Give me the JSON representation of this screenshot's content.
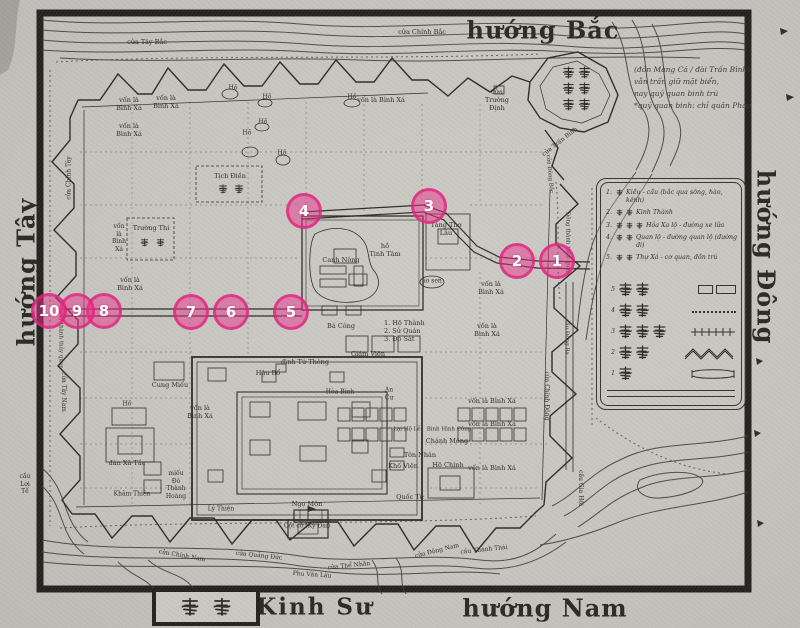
{
  "colors": {
    "paper": "#c6c4bf",
    "ink": "#2e2c26",
    "frame": "#24221e",
    "marker_pink": "#e83490",
    "marker_fill": "rgba(232,52,140,0.5)"
  },
  "compass": {
    "north": "hướng Bắc",
    "south": "hướng Nam",
    "east": "hướng Đông",
    "west": "hướng Tây",
    "capital": "Kinh Sư",
    "capital_seal": "京師"
  },
  "note": {
    "lines": [
      "(đồn Mang Cá / đài Trấn Bình)",
      "vẫn trấn giữ mặt biển,",
      "nay quý quan binh trú",
      "*quý quan binh: chỉ quân Pháp"
    ]
  },
  "legend": {
    "items": [
      {
        "num": "1.",
        "cjk": "橋",
        "text": "Kiều - cầu (bắc qua sông, hào, kênh)"
      },
      {
        "num": "2.",
        "cjk": "京城",
        "text": "Kinh Thành"
      },
      {
        "num": "3.",
        "cjk": "火車路",
        "text": "Hỏa Xa lộ - đường xe lửa"
      },
      {
        "num": "4.",
        "cjk": "官路",
        "text": "Quan lộ - đường quan lộ (đường đi)"
      },
      {
        "num": "5.",
        "cjk": "署舍",
        "text": "Thự Xá - cơ quan, đồn trú"
      }
    ],
    "glyph_rows": [
      {
        "num": "5",
        "cjk": "署舍",
        "sym": "rects"
      },
      {
        "num": "4",
        "cjk": "官路",
        "sym": "dots"
      },
      {
        "num": "3",
        "cjk": "火車路",
        "sym": "rail"
      },
      {
        "num": "2",
        "cjk": "京城",
        "sym": "zigzag"
      },
      {
        "num": "1",
        "cjk": "橋",
        "sym": "bridge"
      }
    ]
  },
  "markers": [
    {
      "n": "1",
      "x": 557,
      "y": 261
    },
    {
      "n": "2",
      "x": 517,
      "y": 261
    },
    {
      "n": "3",
      "x": 429,
      "y": 206
    },
    {
      "n": "4",
      "x": 304,
      "y": 211
    },
    {
      "n": "5",
      "x": 291,
      "y": 312
    },
    {
      "n": "6",
      "x": 231,
      "y": 312
    },
    {
      "n": "7",
      "x": 191,
      "y": 312
    },
    {
      "n": "8",
      "x": 104,
      "y": 311
    },
    {
      "n": "9",
      "x": 77,
      "y": 311
    },
    {
      "n": "10",
      "x": 49,
      "y": 311
    }
  ],
  "map_labels": [
    {
      "t": "cửa Tây Bắc",
      "x": 147,
      "y": 42
    },
    {
      "t": "cửa Chính Bắc",
      "x": 422,
      "y": 32
    },
    {
      "t": "cửa\nTrường\nĐịnh",
      "x": 497,
      "y": 100
    },
    {
      "t": "cửa Trấn Bình",
      "x": 560,
      "y": 142,
      "rot": -38,
      "s": 6
    },
    {
      "t": "cửa Đông Bắc",
      "x": 549,
      "y": 174,
      "rot": 85,
      "s": 5.5
    },
    {
      "t": "vốn là\nBình Xá",
      "x": 129,
      "y": 104
    },
    {
      "t": "vốn là\nBình Xá",
      "x": 166,
      "y": 102
    },
    {
      "t": "vốn là\nBình Xá",
      "x": 129,
      "y": 130
    },
    {
      "t": "vốn là Bình Xá",
      "x": 381,
      "y": 100
    },
    {
      "t": "Hồ",
      "x": 233,
      "y": 88,
      "s": 6
    },
    {
      "t": "Hồ",
      "x": 267,
      "y": 97,
      "s": 6
    },
    {
      "t": "Hồ",
      "x": 263,
      "y": 122,
      "s": 6
    },
    {
      "t": "Hồ",
      "x": 247,
      "y": 133,
      "s": 6
    },
    {
      "t": "Hồ",
      "x": 352,
      "y": 97,
      "s": 6
    },
    {
      "t": "Hồ",
      "x": 282,
      "y": 153,
      "s": 6
    },
    {
      "t": "Tịch Điền",
      "x": 230,
      "y": 176
    },
    {
      "t": "Trường Thi",
      "x": 151,
      "y": 228
    },
    {
      "t": "vốn\nlà\nBình\nXá",
      "x": 119,
      "y": 238,
      "s": 6
    },
    {
      "t": "vốn là\nBình Xá",
      "x": 130,
      "y": 284
    },
    {
      "t": "hồ\nTịnh Tâm",
      "x": 385,
      "y": 250
    },
    {
      "t": "Canh Nông",
      "x": 341,
      "y": 260
    },
    {
      "t": "Tàng Thơ\nLâu",
      "x": 446,
      "y": 229
    },
    {
      "t": "ao sen",
      "x": 432,
      "y": 281,
      "s": 6
    },
    {
      "t": "vốn là\nBình Xá",
      "x": 491,
      "y": 288
    },
    {
      "t": "vốn là\nBình Xá",
      "x": 487,
      "y": 330
    },
    {
      "t": "Bá Công",
      "x": 341,
      "y": 326
    },
    {
      "t": "1. Hộ Thành\n2. Sử Quán\n3. Đô Sát",
      "x": 409,
      "y": 331,
      "align": "left",
      "w": 50
    },
    {
      "t": "Giám Viện",
      "x": 368,
      "y": 354
    },
    {
      "t": "đình Tứ Thông",
      "x": 305,
      "y": 362
    },
    {
      "t": "Hậu Bổ",
      "x": 268,
      "y": 373
    },
    {
      "t": "Hòa Bình",
      "x": 340,
      "y": 392,
      "s": 6
    },
    {
      "t": "An\nCư",
      "x": 389,
      "y": 394,
      "s": 6
    },
    {
      "t": "Cung Miếu",
      "x": 170,
      "y": 385
    },
    {
      "t": "Hồ",
      "x": 127,
      "y": 404,
      "s": 6
    },
    {
      "t": "vốn là\nBình Xá",
      "x": 200,
      "y": 412
    },
    {
      "t": "vốn là Bình Xá",
      "x": 492,
      "y": 401
    },
    {
      "t": "vốn là Bình Xá",
      "x": 492,
      "y": 424
    },
    {
      "t": "vốn là Bình Xá",
      "x": 492,
      "y": 468
    },
    {
      "t": "Lại  Hộ  Lễ",
      "x": 407,
      "y": 430,
      "s": 5.5
    },
    {
      "t": "Binh Hình Công",
      "x": 449,
      "y": 430,
      "s": 5.5
    },
    {
      "t": "Chánh Mông",
      "x": 447,
      "y": 441
    },
    {
      "t": "Tôn Nhân",
      "x": 420,
      "y": 455
    },
    {
      "t": "Khố Viện",
      "x": 403,
      "y": 466
    },
    {
      "t": "Hộ Chính",
      "x": 448,
      "y": 465
    },
    {
      "t": "Quốc Tử",
      "x": 410,
      "y": 497
    },
    {
      "t": "đàn Xã Tắc",
      "x": 127,
      "y": 463
    },
    {
      "t": "Khâm Thiên",
      "x": 132,
      "y": 494,
      "s": 6
    },
    {
      "t": "miếu\nĐô\nThành\nHoàng",
      "x": 176,
      "y": 485,
      "s": 6
    },
    {
      "t": "Lý Thiện",
      "x": 221,
      "y": 509,
      "s": 6
    },
    {
      "t": "Ngọ Môn",
      "x": 307,
      "y": 504
    },
    {
      "t": "Cột cờ (Kỳ Đài)",
      "x": 307,
      "y": 526,
      "s": 6
    },
    {
      "t": "cửa Chính Nam",
      "x": 182,
      "y": 556,
      "rot": 10,
      "s": 6
    },
    {
      "t": "cửa Quảng Đức",
      "x": 259,
      "y": 556,
      "rot": 6,
      "s": 6
    },
    {
      "t": "Phu Văn Lâu",
      "x": 312,
      "y": 575,
      "rot": 4,
      "s": 6
    },
    {
      "t": "cửa Thể Nhân",
      "x": 349,
      "y": 566,
      "rot": -6,
      "s": 6
    },
    {
      "t": "cửa Đông Nam",
      "x": 437,
      "y": 551,
      "rot": -14,
      "s": 6
    },
    {
      "t": "cầu Thành Thái",
      "x": 484,
      "y": 550,
      "rot": -6,
      "s": 6
    },
    {
      "t": "cầu Gia Hội",
      "x": 580,
      "y": 488,
      "rot": 90,
      "s": 6
    },
    {
      "t": "cửa Chính Đông",
      "x": 546,
      "y": 396,
      "rot": 90,
      "s": 6
    },
    {
      "t": "cầu Đông Ba",
      "x": 566,
      "y": 337,
      "rot": 90,
      "s": 5.5
    },
    {
      "t": "Đông thành thủy quan",
      "x": 567,
      "y": 243,
      "rot": 90,
      "s": 5.5
    },
    {
      "t": "cửa Chính Tây",
      "x": 69,
      "y": 178,
      "rot": -90,
      "s": 6
    },
    {
      "t": "Tây thành thủy quan",
      "x": 60,
      "y": 340,
      "rot": 90,
      "s": 5.5
    },
    {
      "t": "cửa Tây Nam",
      "x": 63,
      "y": 392,
      "rot": 90,
      "s": 6
    },
    {
      "t": "cầu\nLợi\nTế",
      "x": 25,
      "y": 484,
      "s": 6
    }
  ]
}
